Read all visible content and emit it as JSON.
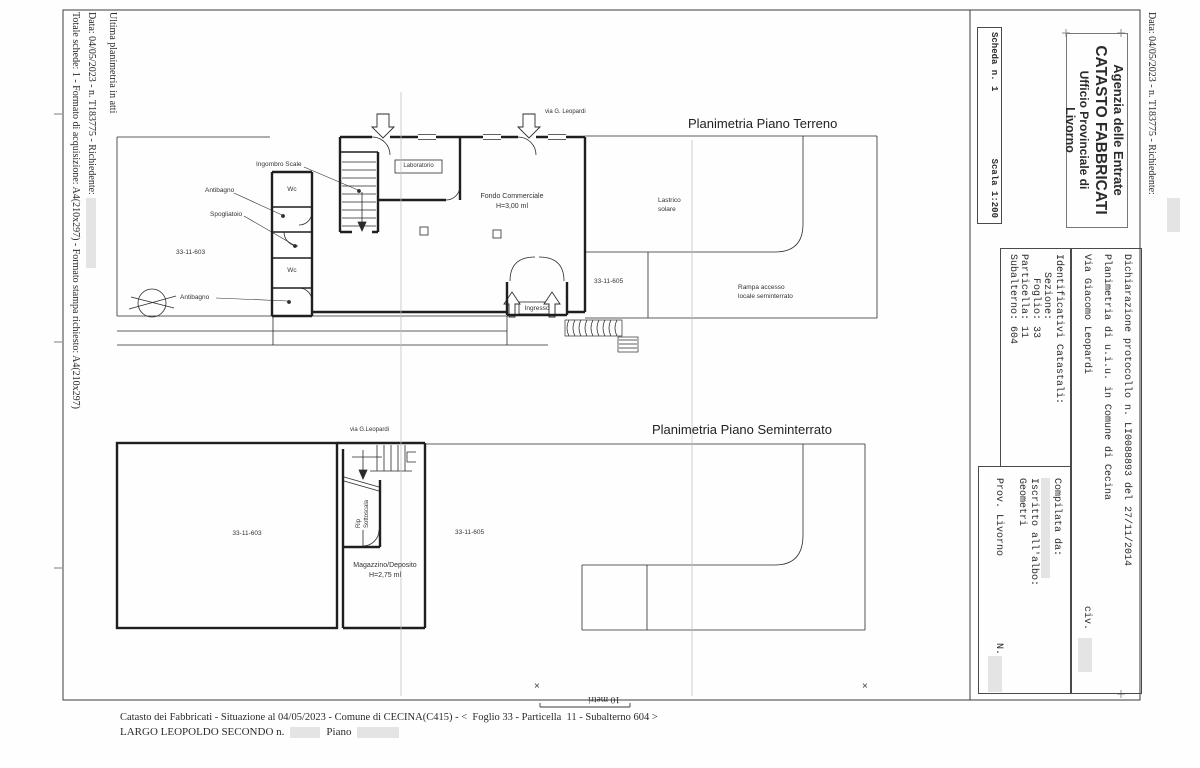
{
  "document": {
    "margins": {
      "left_line1": "Ultima planimetria in atti",
      "left_line2": "Data: 04/05/2023 - n. T183775 - Richiedente:",
      "left_line3": "Totale schede: 1 - Formato di acquisizione: A4(210x297) - Formato stampa richiesto: A4(210x297)",
      "right_line1": "Data: 04/05/2023 - n. T183775 - Richiedente:"
    },
    "scheda_box": {
      "scheda": "Scheda n. 1",
      "scala": "Scala 1:200"
    },
    "agency": {
      "line1": "Agenzia delle Entrate",
      "line2": "CATASTO FABBRICATI",
      "line3": "Ufficio Provinciale di",
      "line4": "Livorno"
    },
    "dichiarazione": {
      "line1": "Dichiarazione protocollo n. LI0088893 del 27/11/2014",
      "line2": "Planimetria di u.i.u. in Comune di Cecina",
      "line3": "Via Giacomo Leopardi",
      "civ": "civ."
    },
    "identificativi": {
      "title": "Identificativi Catastali:",
      "sezione": "   Sezione:",
      "foglio": "    Foglio: 33",
      "particella": "Particella: 11",
      "subalterno": "Subalterno: 604"
    },
    "compilata": {
      "title": "Compilata da:",
      "iscritto": "Iscritto all'albo:",
      "albo": "Geometri",
      "prov": "Prov. Livorno",
      "n_label": "N."
    },
    "plans": {
      "terreno": {
        "title": "Planimetria Piano Terreno",
        "street": "via G. Leopardi",
        "labels": {
          "ingombro_scale": "Ingombro Scale",
          "antibagno1": "Antibagno",
          "spogliatoio": "Spogliatoio",
          "wc1": "Wc",
          "wc2": "Wc",
          "antibagno2": "Antibagno",
          "unit_left": "33-11-603",
          "laboratorio": "Laboratorio",
          "fondo1": "Fondo Commerciale",
          "fondo2": "H=3,00 ml",
          "lastrico1": "Lastrico",
          "lastrico2": "solare",
          "unit_right": "33-11-605",
          "rampa1": "Rampa accesso",
          "rampa2": "locale seminterrato",
          "ingresso": "Ingresso"
        }
      },
      "seminterrato": {
        "title": "Planimetria Piano Seminterrato",
        "street": "via G.Leopardi",
        "labels": {
          "unit_left": "33-11-603",
          "unit_right": "33-11-605",
          "rip1": "Rip",
          "rip2": "Sottoscala",
          "magazzino1": "Magazzino/Deposito",
          "magazzino2": "H=2,75 ml"
        }
      }
    },
    "footer": {
      "line1": "Catasto dei Fabbricati - Situazione al 04/05/2023 - Comune di CECINA(C415) - <  Foglio 33 - Particella  11 - Subalterno 604 >",
      "line2_street": "LARGO LEOPOLDO SECONDO n.",
      "line2_piano": "Piano",
      "scale_note": "10 metri",
      "cross_mark": "×"
    },
    "colors": {
      "redaction": "#e4e4e4",
      "ink": "#2b2b2b"
    }
  }
}
